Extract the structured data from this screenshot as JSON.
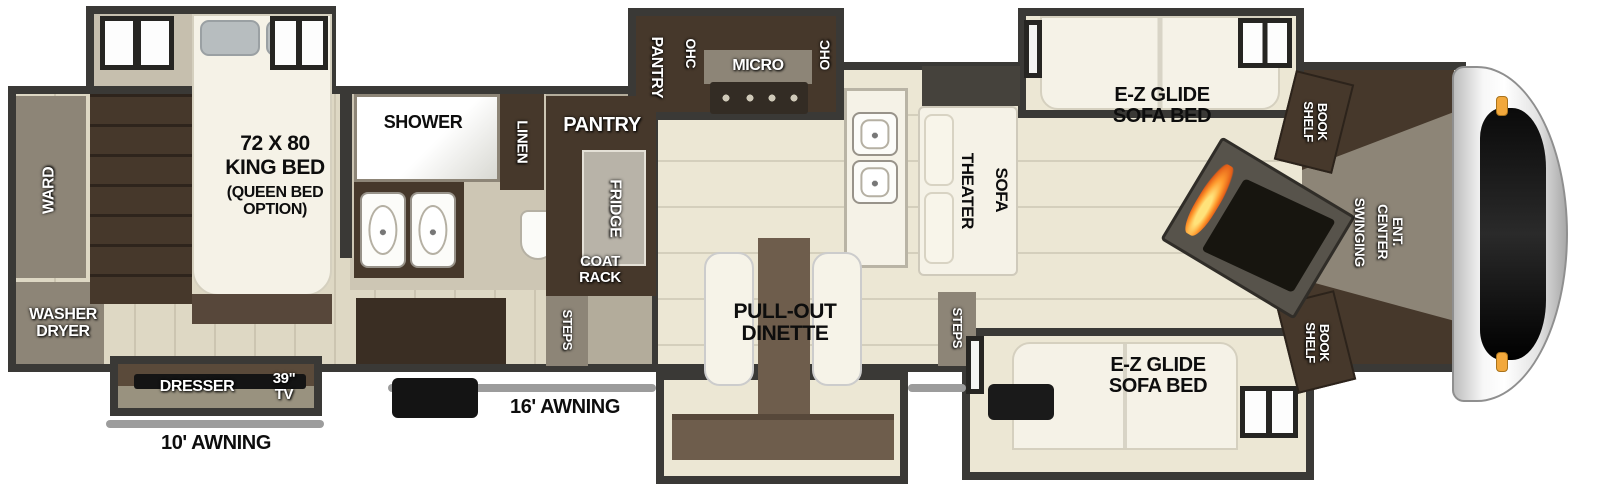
{
  "title": "Fifth Wheel RV Floorplan",
  "colors": {
    "wall": "#3a3936",
    "floor_living": "#ece7d4",
    "floor_bedroom": "#ded8c4",
    "floor_bath": "#cdc6b4",
    "floor_kitchen": "#b3ac9b",
    "slide_floor": "#c6bfae",
    "cabinet": "#46382b",
    "cabinet_dark": "#3a2e23",
    "taupe": "#8d8577",
    "white_furn": "#f5f2e7",
    "awning": "#9c9c9c",
    "window": "#262522",
    "flame": "#ff9b2e",
    "marker": "#f2a83c",
    "tv_black": "#141414"
  },
  "labels": {
    "ward": "WARD",
    "washer_dryer": "WASHER\nDRYER",
    "king_bed_size": "72 X 80",
    "king_bed_type": "KING BED",
    "king_bed_option": "(QUEEN BED\nOPTION)",
    "dresser": "DRESSER",
    "tv": "39\"\nTV",
    "awning_10": "10' AWNING",
    "shower": "SHOWER",
    "linen": "LINEN",
    "pantry": "PANTRY",
    "fridge": "FRIDGE",
    "coat_rack": "COAT\nRACK",
    "steps": "STEPS",
    "ohc": "OHC",
    "micro": "MICRO",
    "pull_out_dinette": "PULL-OUT\nDINETTE",
    "awning_16": "16' AWNING",
    "theater": "THEATER",
    "sofa": "SOFA",
    "ez_glide_sofa_bed": "E-Z GLIDE\nSOFA BED",
    "book_shelf": "BOOK\nSHELF",
    "swinging": "SWINGING",
    "ent_center": "ENT. CENTER"
  }
}
